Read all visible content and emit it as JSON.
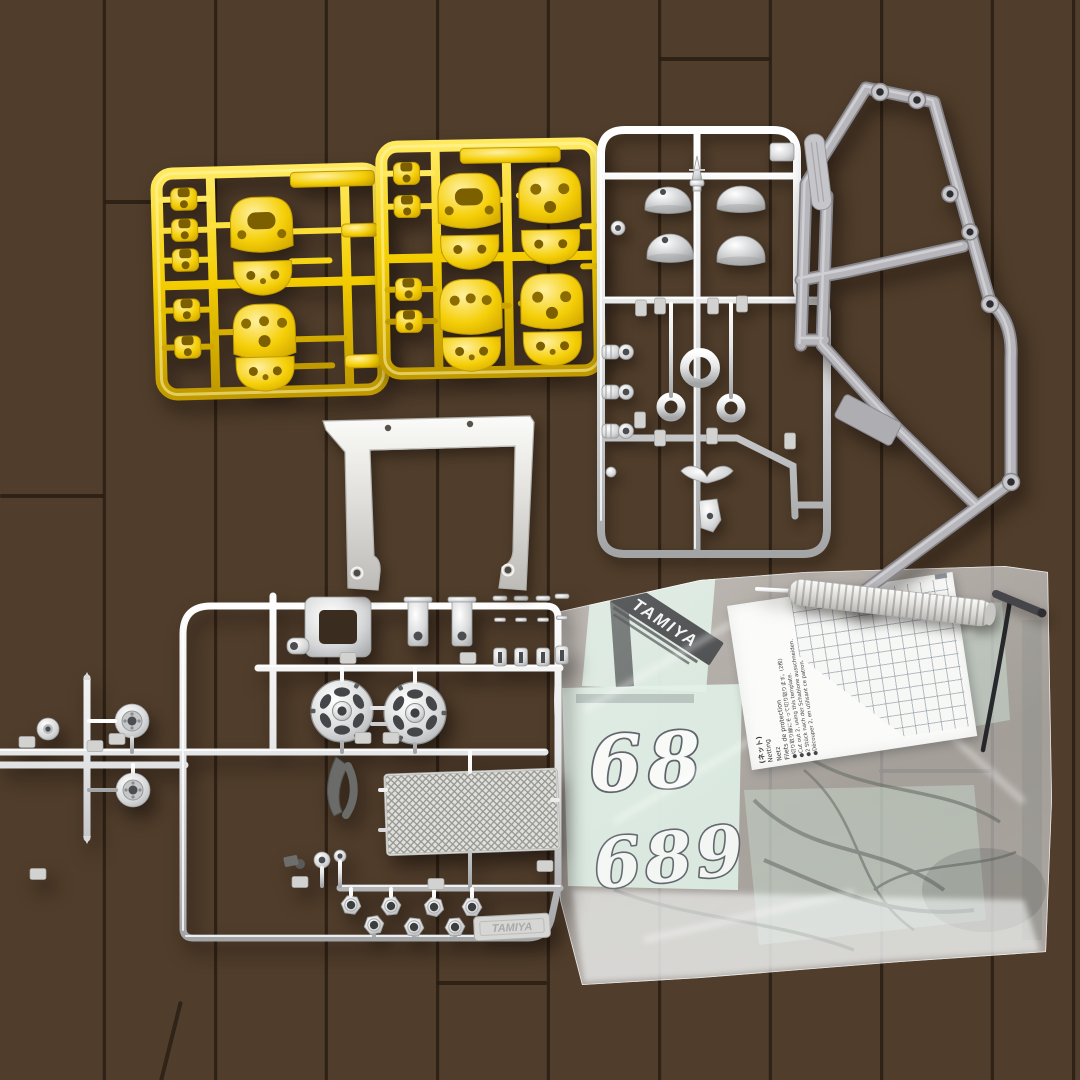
{
  "scene": {
    "name": "tamiya-model-kit-parts-on-wood-floor"
  },
  "colors": {
    "sprue_yellow": "#f2cd05",
    "sprue_chrome": "#d8d9db",
    "cage_gray": "#b7b7bb",
    "wood_brown": "#53402e",
    "decal_mint": "#d8eee1",
    "paper_white": "#fbfbf9"
  },
  "decals": {
    "brand": "TAMIYA",
    "number_row1": "68",
    "number_row2": "689"
  },
  "chassis_tag": {
    "text": "TAMIYA"
  },
  "paper": {
    "header_jp": "(ネット)",
    "name_en": "Netting",
    "name_de": "Netz",
    "name_fr": "Filets de protection",
    "bullet_jp": "●切り取り線にそって切り取ります。(2枚)",
    "bullet_en": "●Cut out 2, using this template.",
    "bullet_de": "●2 Stück nach der Schablone ausschneiden.",
    "bullet_fr": "●Découper 2, en utilisant ce patron."
  }
}
